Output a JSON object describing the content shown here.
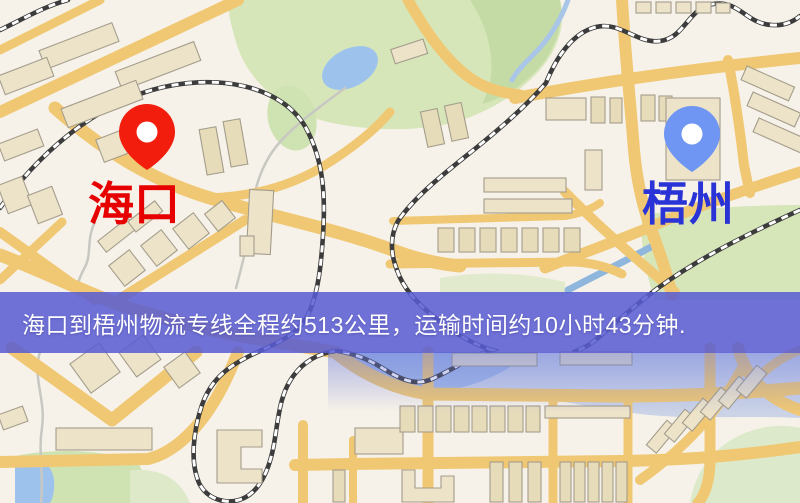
{
  "map": {
    "origin": {
      "label": "海口",
      "label_color": "#e60000",
      "pin_color": "#f21d0d",
      "pin_hole_color": "#ffffff"
    },
    "destination": {
      "label": "梧州",
      "label_color": "#2a33d6",
      "pin_color": "#6e96f2",
      "pin_hole_color": "#ffffff"
    }
  },
  "banner": {
    "text": "海口到梧州物流专线全程约513公里，运输时间约10小时43分钟.",
    "background": "#585cd3",
    "text_color": "#ffffff",
    "distance_km": "513",
    "duration": "10小时43分钟"
  },
  "palette": {
    "road": "#f0c873",
    "park": "#d6e6b9",
    "water": "#9dc3ed",
    "building": "#ece3c9",
    "railway": "#3c3c3c",
    "map_background": "#f7f2e9"
  }
}
